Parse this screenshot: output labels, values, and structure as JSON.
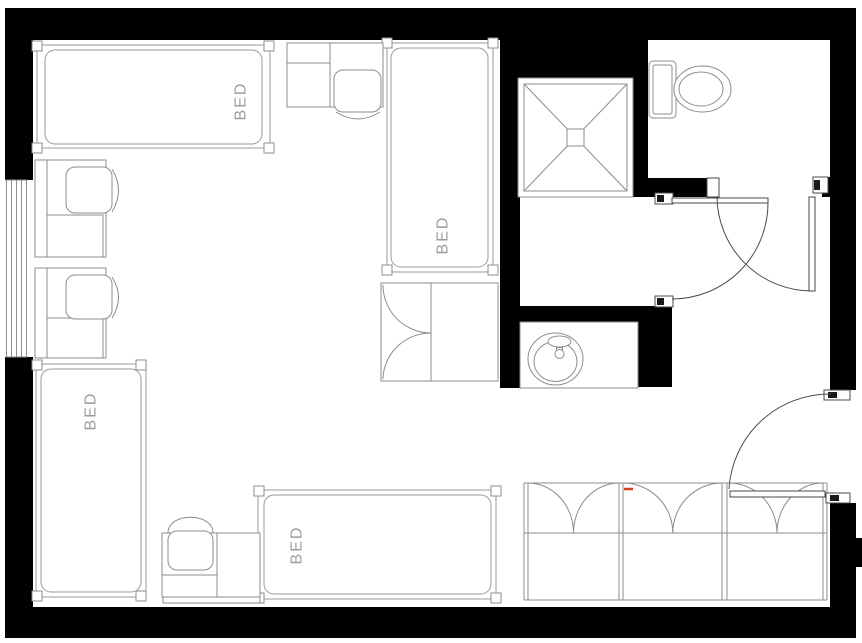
{
  "floor_plan": {
    "type": "dorm-room-floor-plan",
    "beds": [
      {
        "id": "bed-top-left",
        "label": "BED"
      },
      {
        "id": "bed-top-middle",
        "label": "BED"
      },
      {
        "id": "bed-bottom-left",
        "label": "BED"
      },
      {
        "id": "bed-bottom-middle",
        "label": "BED"
      }
    ],
    "fixtures": [
      "shower-stall",
      "toilet-fixture",
      "sink-vanity",
      "window",
      "wardrobe-cabinet",
      "closet-bifold-doors",
      "desk-chair-unit",
      "door-swing"
    ],
    "door_count": 3,
    "closet_sections": 3,
    "desk_units": 4,
    "colors": {
      "wall": "#000000",
      "furniture_line": "#8d8d8d",
      "door_line": "#4a4a4a",
      "bed_label_text": "#9c9c9c",
      "accent_mark": "#cc4125",
      "floor": "#ffffff"
    }
  }
}
